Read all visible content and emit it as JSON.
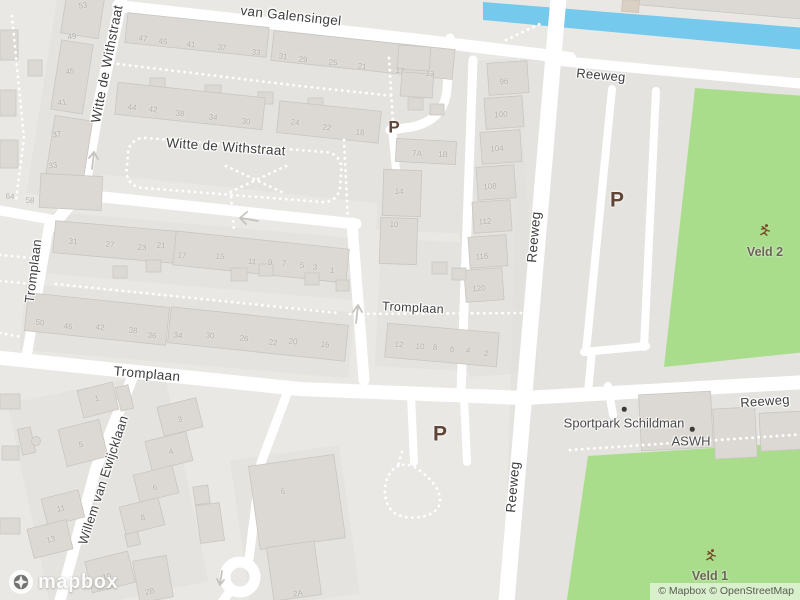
{
  "map": {
    "colors": {
      "water": "#74c9ec",
      "field": "#a9dd8c",
      "road": "#ffffff",
      "land": "#eae8e5",
      "building": "#dcd9d4",
      "street_label": "#3e3e3e",
      "house_number": "#b2afab",
      "parking_label": "#5e4536",
      "poi_label": "#4a4a4a",
      "field_label": "#6b6557"
    },
    "street_labels": [
      {
        "t": "van Galensingel",
        "x": 291,
        "y": 16,
        "r": 6,
        "s": 13.5
      },
      {
        "t": "Witte de Withstraat",
        "x": 107,
        "y": 64,
        "r": -79,
        "s": 13.5
      },
      {
        "t": "Witte de Withstraat",
        "x": 226,
        "y": 147,
        "r": 4,
        "s": 13.5
      },
      {
        "t": "Tromplaan",
        "x": 33,
        "y": 271,
        "r": -83,
        "s": 13
      },
      {
        "t": "Tromplaan",
        "x": 147,
        "y": 374,
        "r": 5,
        "s": 13.5
      },
      {
        "t": "Tromplaan",
        "x": 413,
        "y": 308,
        "r": 3,
        "s": 12.5
      },
      {
        "t": "Reeweg",
        "x": 601,
        "y": 75,
        "r": 5,
        "s": 13
      },
      {
        "t": "Reeweg",
        "x": 534,
        "y": 237,
        "r": -85,
        "s": 13.5
      },
      {
        "t": "Reeweg",
        "x": 513,
        "y": 487,
        "r": -85,
        "s": 13.5
      },
      {
        "t": "Reeweg",
        "x": 765,
        "y": 401,
        "r": -4,
        "s": 13
      },
      {
        "t": "Willem van Ewijcklaan",
        "x": 103,
        "y": 480,
        "r": -72,
        "s": 13
      }
    ],
    "parking_labels": [
      {
        "t": "P",
        "x": 394,
        "y": 127,
        "s": 17
      },
      {
        "t": "P",
        "x": 617,
        "y": 200,
        "s": 21
      },
      {
        "t": "P",
        "x": 440,
        "y": 434,
        "s": 21
      }
    ],
    "poi_labels": [
      {
        "t": "Sportpark Schildman",
        "x": 624,
        "y": 423,
        "dot_x": 624,
        "dot_y": 409
      },
      {
        "t": "ASWH",
        "x": 691,
        "y": 441,
        "dot_x": 692,
        "dot_y": 429
      }
    ],
    "field_labels": [
      {
        "t": "Veld 2",
        "x": 765,
        "y": 252,
        "icon_x": 765,
        "icon_y": 233
      },
      {
        "t": "Veld 1",
        "x": 710,
        "y": 576,
        "icon_x": 711,
        "icon_y": 558
      }
    ],
    "house_numbers": [
      {
        "t": "53",
        "x": 83,
        "y": 6,
        "r": -9
      },
      {
        "t": "49",
        "x": 72,
        "y": 37,
        "r": -9
      },
      {
        "t": "45",
        "x": 70,
        "y": 72,
        "r": -9
      },
      {
        "t": "41",
        "x": 62,
        "y": 103,
        "r": -9
      },
      {
        "t": "37",
        "x": 57,
        "y": 135,
        "r": -9
      },
      {
        "t": "33",
        "x": 53,
        "y": 166,
        "r": -9
      },
      {
        "t": "64",
        "x": 10,
        "y": 197,
        "r": 3
      },
      {
        "t": "58",
        "x": 30,
        "y": 201,
        "r": 3
      },
      {
        "t": "47",
        "x": 143,
        "y": 39,
        "r": 6
      },
      {
        "t": "45",
        "x": 163,
        "y": 42,
        "r": 6
      },
      {
        "t": "41",
        "x": 191,
        "y": 45,
        "r": 6
      },
      {
        "t": "37",
        "x": 222,
        "y": 48,
        "r": 6
      },
      {
        "t": "33",
        "x": 256,
        "y": 53,
        "r": 6
      },
      {
        "t": "31",
        "x": 283,
        "y": 57,
        "r": 6
      },
      {
        "t": "29",
        "x": 303,
        "y": 60,
        "r": 6
      },
      {
        "t": "25",
        "x": 333,
        "y": 63,
        "r": 6
      },
      {
        "t": "21",
        "x": 362,
        "y": 67,
        "r": 6
      },
      {
        "t": "17",
        "x": 400,
        "y": 71,
        "r": 6
      },
      {
        "t": "13",
        "x": 430,
        "y": 74,
        "r": 6
      },
      {
        "t": "44",
        "x": 132,
        "y": 108,
        "r": 6
      },
      {
        "t": "42",
        "x": 153,
        "y": 110,
        "r": 6
      },
      {
        "t": "38",
        "x": 180,
        "y": 114,
        "r": 6
      },
      {
        "t": "34",
        "x": 213,
        "y": 118,
        "r": 6
      },
      {
        "t": "30",
        "x": 246,
        "y": 122,
        "r": 6
      },
      {
        "t": "24",
        "x": 295,
        "y": 123,
        "r": 6
      },
      {
        "t": "22",
        "x": 327,
        "y": 128,
        "r": 6
      },
      {
        "t": "18",
        "x": 360,
        "y": 133,
        "r": 6
      },
      {
        "t": "7A",
        "x": 417,
        "y": 154,
        "r": 3
      },
      {
        "t": "1B",
        "x": 443,
        "y": 155,
        "r": 3
      },
      {
        "t": "14",
        "x": 399,
        "y": 192,
        "r": 3
      },
      {
        "t": "10",
        "x": 394,
        "y": 225,
        "r": 3
      },
      {
        "t": "96",
        "x": 504,
        "y": 82,
        "r": -4
      },
      {
        "t": "100",
        "x": 501,
        "y": 115,
        "r": -4
      },
      {
        "t": "104",
        "x": 497,
        "y": 149,
        "r": -4
      },
      {
        "t": "108",
        "x": 490,
        "y": 187,
        "r": -4
      },
      {
        "t": "112",
        "x": 485,
        "y": 222,
        "r": -4
      },
      {
        "t": "116",
        "x": 482,
        "y": 257,
        "r": -4
      },
      {
        "t": "120",
        "x": 479,
        "y": 289,
        "r": -4
      },
      {
        "t": "31",
        "x": 73,
        "y": 242,
        "r": 5
      },
      {
        "t": "27",
        "x": 110,
        "y": 245,
        "r": 5
      },
      {
        "t": "23",
        "x": 142,
        "y": 248,
        "r": 5
      },
      {
        "t": "21",
        "x": 161,
        "y": 246,
        "r": 5
      },
      {
        "t": "17",
        "x": 182,
        "y": 256,
        "r": 5
      },
      {
        "t": "15",
        "x": 220,
        "y": 257,
        "r": 5
      },
      {
        "t": "11",
        "x": 252,
        "y": 262,
        "r": 5
      },
      {
        "t": "9",
        "x": 270,
        "y": 263,
        "r": 5
      },
      {
        "t": "7",
        "x": 284,
        "y": 264,
        "r": 5
      },
      {
        "t": "5",
        "x": 302,
        "y": 266,
        "r": 5
      },
      {
        "t": "3",
        "x": 315,
        "y": 268,
        "r": 5
      },
      {
        "t": "1",
        "x": 332,
        "y": 271,
        "r": 5
      },
      {
        "t": "50",
        "x": 40,
        "y": 323,
        "r": 6
      },
      {
        "t": "46",
        "x": 68,
        "y": 327,
        "r": 6
      },
      {
        "t": "42",
        "x": 100,
        "y": 328,
        "r": 6
      },
      {
        "t": "38",
        "x": 133,
        "y": 331,
        "r": 6
      },
      {
        "t": "36",
        "x": 152,
        "y": 336,
        "r": 6
      },
      {
        "t": "34",
        "x": 178,
        "y": 336,
        "r": 6
      },
      {
        "t": "30",
        "x": 210,
        "y": 336,
        "r": 6
      },
      {
        "t": "26",
        "x": 244,
        "y": 339,
        "r": 6
      },
      {
        "t": "22",
        "x": 273,
        "y": 343,
        "r": 6
      },
      {
        "t": "20",
        "x": 293,
        "y": 342,
        "r": 6
      },
      {
        "t": "16",
        "x": 325,
        "y": 345,
        "r": 6
      },
      {
        "t": "12",
        "x": 399,
        "y": 345,
        "r": 5
      },
      {
        "t": "10",
        "x": 420,
        "y": 347,
        "r": 5
      },
      {
        "t": "8",
        "x": 435,
        "y": 348,
        "r": 5
      },
      {
        "t": "6",
        "x": 452,
        "y": 350,
        "r": 5
      },
      {
        "t": "4",
        "x": 468,
        "y": 351,
        "r": 5
      },
      {
        "t": "2",
        "x": 486,
        "y": 354,
        "r": 5
      },
      {
        "t": "1",
        "x": 97,
        "y": 399,
        "r": -14
      },
      {
        "t": "5",
        "x": 81,
        "y": 445,
        "r": -14
      },
      {
        "t": "11",
        "x": 61,
        "y": 509,
        "r": -14
      },
      {
        "t": "13",
        "x": 51,
        "y": 540,
        "r": -14
      },
      {
        "t": "3",
        "x": 180,
        "y": 420,
        "r": -14
      },
      {
        "t": "4",
        "x": 171,
        "y": 452,
        "r": -14
      },
      {
        "t": "6",
        "x": 155,
        "y": 488,
        "r": -14
      },
      {
        "t": "8",
        "x": 143,
        "y": 518,
        "r": -14
      },
      {
        "t": "10",
        "x": 107,
        "y": 577,
        "r": -14
      },
      {
        "t": "2B",
        "x": 150,
        "y": 592,
        "r": -10
      },
      {
        "t": "6",
        "x": 283,
        "y": 492,
        "r": -8
      },
      {
        "t": "2A",
        "x": 298,
        "y": 594,
        "r": -8
      }
    ]
  },
  "logo": {
    "text": "mapbox"
  },
  "attribution": {
    "text": "© Mapbox © OpenStreetMap"
  }
}
